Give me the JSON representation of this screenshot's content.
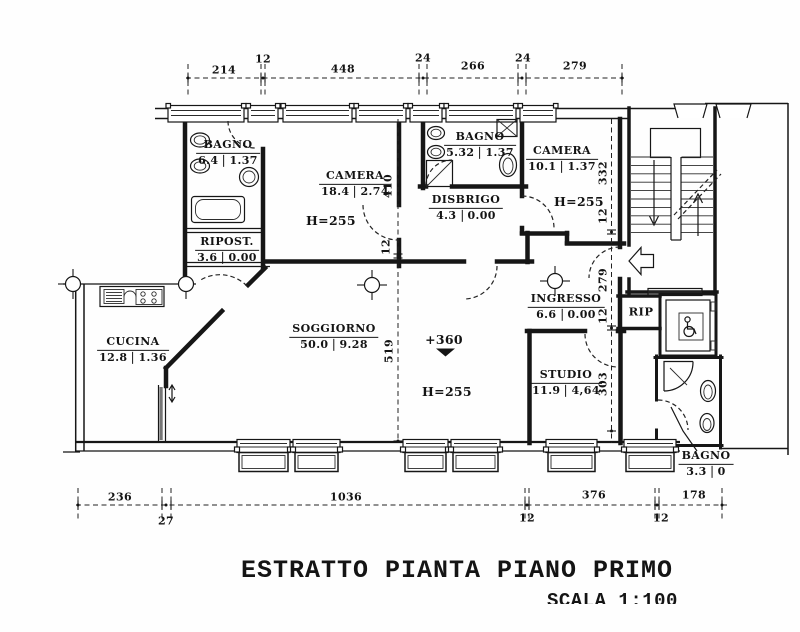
{
  "title": "ESTRATTO PIANTA PIANO PRIMO",
  "scale_label": "SCALA 1:100",
  "rooms": {
    "bagno_nw": {
      "name": "BAGNO",
      "area": "6.4",
      "val": "1.37"
    },
    "ripost": {
      "name": "RIPOST.",
      "area": "3.6",
      "val": "0.00"
    },
    "cucina": {
      "name": "CUCINA",
      "area": "12.8",
      "val": "1.36"
    },
    "camera_w": {
      "name": "CAMERA",
      "area": "18.4",
      "val": "2.74"
    },
    "bagno_c": {
      "name": "BAGNO",
      "area": "5.32",
      "val": "1.37"
    },
    "disbrigo": {
      "name": "DISBRIGO",
      "area": "4.3",
      "val": "0.00"
    },
    "camera_e": {
      "name": "CAMERA",
      "area": "10.1",
      "val": "1.37"
    },
    "soggiorno": {
      "name": "SOGGIORNO",
      "area": "50.0",
      "val": "9.28"
    },
    "ingresso": {
      "name": "INGRESSO",
      "area": "6.6",
      "val": "0.00"
    },
    "studio": {
      "name": "STUDIO",
      "area": "11.9",
      "val": "4,64"
    },
    "rip": {
      "name": "RIP"
    },
    "bagno_se": {
      "name": "BAGNO",
      "area": "3.3",
      "val": "0"
    }
  },
  "annotations": {
    "h_camera_w": "H=255",
    "h_camera_e": "H=255",
    "h_soggiorno": "H=255",
    "level_mark": "+360"
  },
  "dimensions": {
    "top": [
      "214",
      "12",
      "448",
      "24",
      "266",
      "24",
      "279"
    ],
    "bottom": [
      "236",
      "27",
      "1036",
      "12",
      "376",
      "12",
      "178"
    ],
    "left": [
      "410",
      "12",
      "519"
    ],
    "right": [
      "332",
      "12",
      "279",
      "12",
      "303"
    ]
  }
}
